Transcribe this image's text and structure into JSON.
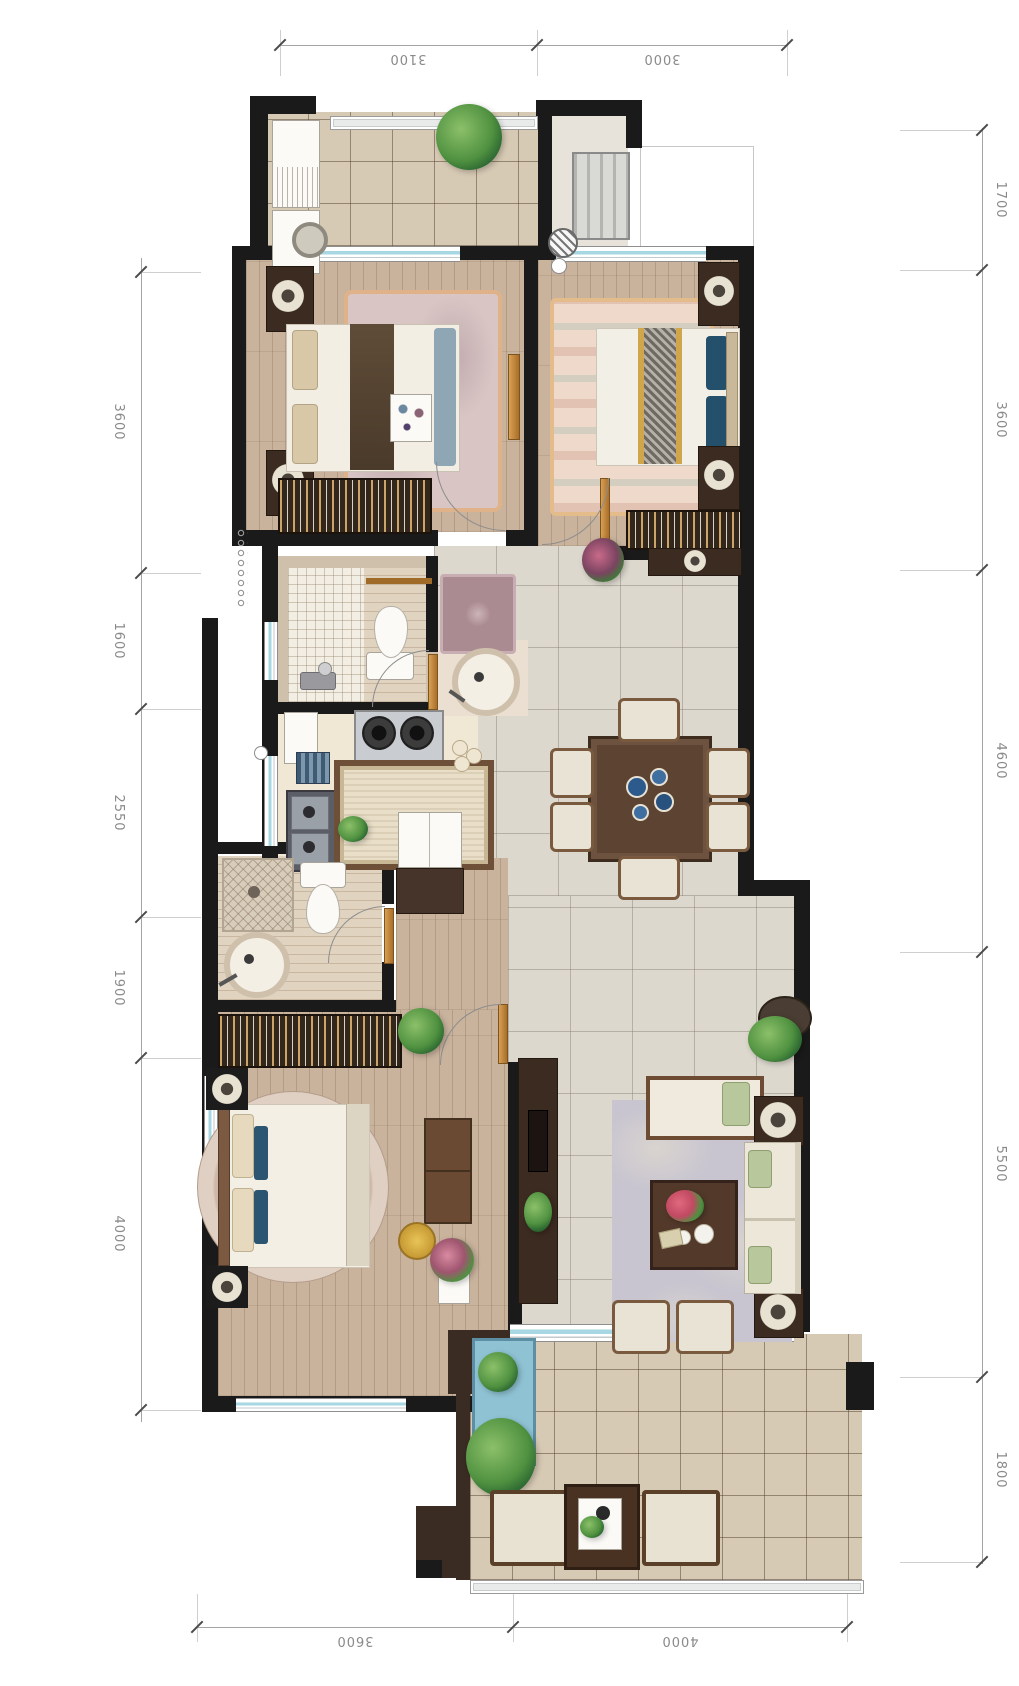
{
  "sheet": {
    "kind": "residential floor plan",
    "units_shown": false
  },
  "dimensions": {
    "top": [
      {
        "label": "3100"
      },
      {
        "label": "3000"
      }
    ],
    "bottom": [
      {
        "label": "3600"
      },
      {
        "label": "4000"
      }
    ],
    "left": [
      {
        "label": "3600"
      },
      {
        "label": "1600"
      },
      {
        "label": "2550"
      },
      {
        "label": "1900"
      },
      {
        "label": "4000"
      }
    ],
    "right": [
      {
        "label": "1700"
      },
      {
        "label": "3600"
      },
      {
        "label": "4600"
      },
      {
        "label": "5500"
      },
      {
        "label": "1800"
      }
    ]
  },
  "colors": {
    "wall": "#1a1a1a",
    "wood_floor": "#c9b39d",
    "tile_floor": "#d7cab4",
    "stone_floor": "#ddd8ce",
    "window_glass": "#a6d7e2",
    "dark_wood": "#3c2b20",
    "fabric_cream": "#e9e3d5",
    "pillow_navy": "#24506b",
    "plant_green": "#4f9140",
    "rug_living": "#c8c5d0",
    "rug_bedroom2": "#d9c6c4",
    "rug_bedroom3": "#eed9ca",
    "dim_line": "#a4a4a4",
    "dim_text": "#8a8a8a",
    "gold_runner": "#cfa64c",
    "water": "#8fc3d4"
  },
  "furniture": {
    "north_balcony": [
      "laundry-cabinet",
      "washing-machine",
      "plant"
    ],
    "entry": [
      "radiator-cabinet",
      "door-stop-hatch"
    ],
    "bedroom_2": [
      "bed",
      "runner-throw",
      "bed-tray",
      "nightstand-lamp x2",
      "area-rug",
      "wardrobe",
      "door"
    ],
    "bedroom_3": [
      "bed",
      "gold-runner",
      "nightstand-lamp x2",
      "area-rug",
      "wardrobe",
      "door"
    ],
    "bathroom_1": [
      "mosaic-shower",
      "toilet",
      "towel-bar",
      "door"
    ],
    "hallway": [
      "accent-rug",
      "console-table",
      "flower-plant",
      "round-basin"
    ],
    "kitchen": [
      "gas-stove",
      "cutting-board",
      "dish-rack",
      "double-sink",
      "island-mat",
      "cart",
      "cabinet"
    ],
    "bathroom_2": [
      "shower-tray",
      "toilet",
      "round-basin",
      "door"
    ],
    "dining": [
      "table",
      "chairs x6",
      "centerpiece"
    ],
    "living": [
      "tv-cabinet",
      "daybed",
      "sofa",
      "side-table x2",
      "coffee-table",
      "area-rug",
      "lounge-chair x2",
      "floor-plant"
    ],
    "master_bedroom": [
      "wardrobe",
      "bed",
      "round-rug",
      "nightstand-lamp x2",
      "dresser",
      "stool",
      "flower-stand",
      "plant"
    ],
    "south_balcony": [
      "water-trough",
      "plant x2",
      "armchair x2",
      "tea-table",
      "railing"
    ]
  }
}
